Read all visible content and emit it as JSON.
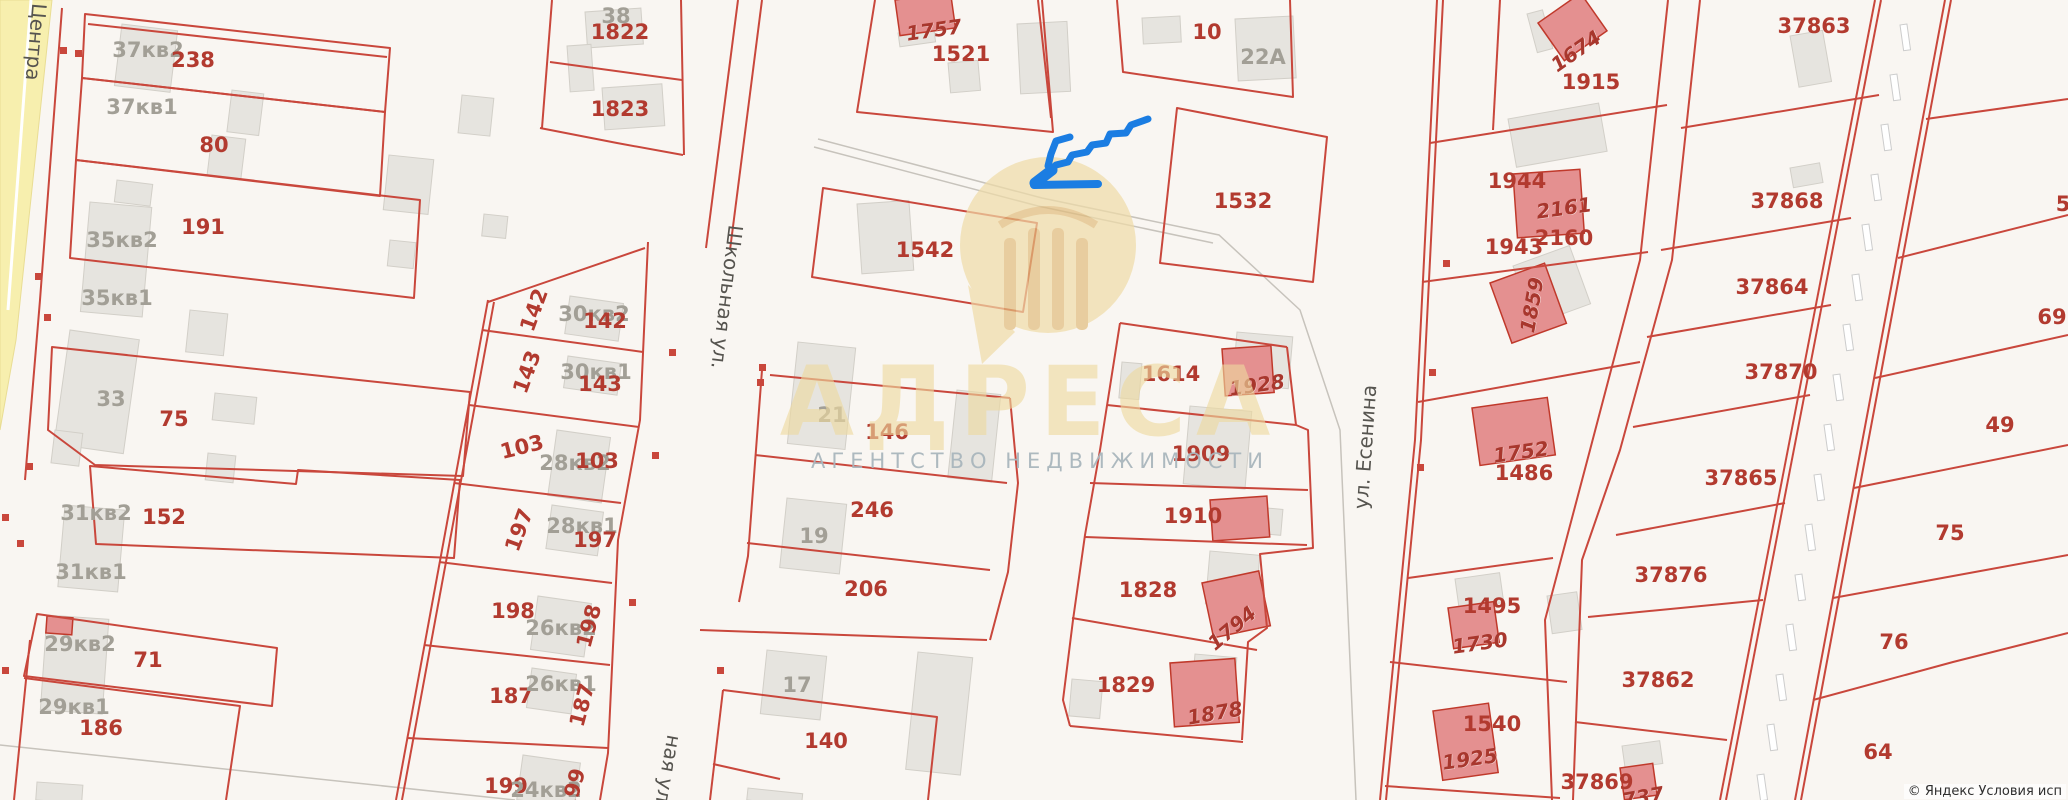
{
  "map": {
    "background": "#f9f6f2",
    "boundary_color": "#c9473c",
    "road_fill_yellow": "#f7efae",
    "building_grey": "#e6e4df",
    "building_red": "#e49090",
    "arrow_color": "#1b7de2",
    "watermark": {
      "title": "АДРЕСА",
      "subtitle": "АГЕНТСТВО НЕДВИЖИМОСТИ",
      "title_color": "#eeda9f",
      "subtitle_color": "#a9b6bd",
      "logo_color": "#ecd6a2"
    },
    "attribution": "© Яндекс  Условия исп",
    "labels": [
      {
        "t": "Центра",
        "x": 36,
        "y": 42,
        "r": 95,
        "k": "s"
      },
      {
        "t": "Школьная ул.",
        "x": 727,
        "y": 297,
        "r": 97,
        "k": "s"
      },
      {
        "t": "ная ул.",
        "x": 668,
        "y": 772,
        "r": 100,
        "k": "s"
      },
      {
        "t": "ул. Есенина",
        "x": 1365,
        "y": 447,
        "r": -86,
        "k": "s"
      },
      {
        "t": "37кв2",
        "x": 148,
        "y": 50,
        "k": "g"
      },
      {
        "t": "238",
        "x": 193,
        "y": 60,
        "k": "p"
      },
      {
        "t": "37кв1",
        "x": 142,
        "y": 107,
        "k": "g"
      },
      {
        "t": "80",
        "x": 214,
        "y": 145,
        "k": "p"
      },
      {
        "t": "35кв2",
        "x": 122,
        "y": 240,
        "k": "g"
      },
      {
        "t": "191",
        "x": 203,
        "y": 227,
        "k": "p"
      },
      {
        "t": "35кв1",
        "x": 117,
        "y": 298,
        "k": "g"
      },
      {
        "t": "33",
        "x": 111,
        "y": 399,
        "k": "g"
      },
      {
        "t": "75",
        "x": 174,
        "y": 419,
        "k": "p"
      },
      {
        "t": "31кв2",
        "x": 96,
        "y": 513,
        "k": "g"
      },
      {
        "t": "152",
        "x": 164,
        "y": 517,
        "k": "p"
      },
      {
        "t": "31кв1",
        "x": 91,
        "y": 572,
        "k": "g"
      },
      {
        "t": "29кв2",
        "x": 80,
        "y": 644,
        "k": "g"
      },
      {
        "t": "71",
        "x": 148,
        "y": 660,
        "k": "p"
      },
      {
        "t": "29кв1",
        "x": 74,
        "y": 707,
        "k": "g"
      },
      {
        "t": "186",
        "x": 101,
        "y": 728,
        "k": "p"
      },
      {
        "t": "38",
        "x": 616,
        "y": 16,
        "k": "g"
      },
      {
        "t": "1822",
        "x": 620,
        "y": 32,
        "k": "p"
      },
      {
        "t": "1823",
        "x": 620,
        "y": 109,
        "k": "p"
      },
      {
        "t": "142",
        "x": 534,
        "y": 310,
        "r": -70,
        "k": "p"
      },
      {
        "t": "30кв2",
        "x": 594,
        "y": 314,
        "k": "g"
      },
      {
        "t": "142",
        "x": 605,
        "y": 321,
        "k": "p"
      },
      {
        "t": "143",
        "x": 527,
        "y": 372,
        "r": -70,
        "k": "p"
      },
      {
        "t": "30кв1",
        "x": 596,
        "y": 372,
        "k": "g"
      },
      {
        "t": "143",
        "x": 600,
        "y": 384,
        "k": "p"
      },
      {
        "t": "103",
        "x": 522,
        "y": 447,
        "r": -14,
        "k": "p"
      },
      {
        "t": "28кв2",
        "x": 575,
        "y": 463,
        "k": "g"
      },
      {
        "t": "103",
        "x": 597,
        "y": 461,
        "k": "p"
      },
      {
        "t": "197",
        "x": 519,
        "y": 530,
        "r": -70,
        "k": "p"
      },
      {
        "t": "28кв1",
        "x": 582,
        "y": 526,
        "k": "g"
      },
      {
        "t": "197",
        "x": 595,
        "y": 540,
        "k": "p"
      },
      {
        "t": "198",
        "x": 513,
        "y": 611,
        "k": "p"
      },
      {
        "t": "26кв2",
        "x": 561,
        "y": 628,
        "k": "g"
      },
      {
        "t": "198",
        "x": 589,
        "y": 626,
        "r": -75,
        "k": "p"
      },
      {
        "t": "187",
        "x": 511,
        "y": 696,
        "k": "p"
      },
      {
        "t": "26кв1",
        "x": 561,
        "y": 684,
        "k": "g"
      },
      {
        "t": "187",
        "x": 582,
        "y": 705,
        "r": -75,
        "k": "p"
      },
      {
        "t": "199",
        "x": 506,
        "y": 786,
        "k": "p"
      },
      {
        "t": "24кв2",
        "x": 546,
        "y": 790,
        "k": "g"
      },
      {
        "t": "199",
        "x": 573,
        "y": 790,
        "r": -75,
        "k": "p"
      },
      {
        "t": "1757",
        "x": 934,
        "y": 30,
        "r": -8,
        "k": "bi"
      },
      {
        "t": "1521",
        "x": 961,
        "y": 54,
        "k": "p"
      },
      {
        "t": "10",
        "x": 1207,
        "y": 32,
        "k": "p"
      },
      {
        "t": "22A",
        "x": 1263,
        "y": 57,
        "k": "g"
      },
      {
        "t": "1532",
        "x": 1243,
        "y": 201,
        "k": "p"
      },
      {
        "t": "1542",
        "x": 925,
        "y": 250,
        "k": "p"
      },
      {
        "t": "21",
        "x": 832,
        "y": 415,
        "k": "g"
      },
      {
        "t": "146",
        "x": 887,
        "y": 432,
        "k": "p"
      },
      {
        "t": "246",
        "x": 872,
        "y": 510,
        "k": "p"
      },
      {
        "t": "19",
        "x": 814,
        "y": 536,
        "k": "g"
      },
      {
        "t": "206",
        "x": 866,
        "y": 589,
        "k": "p"
      },
      {
        "t": "17",
        "x": 797,
        "y": 685,
        "k": "g"
      },
      {
        "t": "140",
        "x": 826,
        "y": 741,
        "k": "p"
      },
      {
        "t": "1614",
        "x": 1171,
        "y": 374,
        "k": "p"
      },
      {
        "t": "1928",
        "x": 1257,
        "y": 385,
        "r": -8,
        "k": "bi"
      },
      {
        "t": "1909",
        "x": 1201,
        "y": 454,
        "k": "p"
      },
      {
        "t": "1910",
        "x": 1193,
        "y": 516,
        "k": "p"
      },
      {
        "t": "1828",
        "x": 1148,
        "y": 590,
        "k": "p"
      },
      {
        "t": "1794",
        "x": 1232,
        "y": 628,
        "r": -40,
        "k": "bi"
      },
      {
        "t": "1829",
        "x": 1126,
        "y": 685,
        "k": "p"
      },
      {
        "t": "1878",
        "x": 1215,
        "y": 713,
        "r": -10,
        "k": "bi"
      },
      {
        "t": "1674",
        "x": 1576,
        "y": 51,
        "r": -35,
        "k": "bi"
      },
      {
        "t": "1915",
        "x": 1591,
        "y": 82,
        "k": "p"
      },
      {
        "t": "1944",
        "x": 1517,
        "y": 181,
        "k": "p"
      },
      {
        "t": "2161",
        "x": 1564,
        "y": 208,
        "r": -8,
        "k": "bi"
      },
      {
        "t": "2160",
        "x": 1564,
        "y": 238,
        "k": "p"
      },
      {
        "t": "1943",
        "x": 1514,
        "y": 247,
        "k": "p"
      },
      {
        "t": "1859",
        "x": 1532,
        "y": 305,
        "r": -80,
        "k": "bi"
      },
      {
        "t": "1752",
        "x": 1521,
        "y": 452,
        "r": -8,
        "k": "bi"
      },
      {
        "t": "1486",
        "x": 1524,
        "y": 473,
        "k": "p"
      },
      {
        "t": "1495",
        "x": 1492,
        "y": 606,
        "k": "p"
      },
      {
        "t": "1730",
        "x": 1480,
        "y": 643,
        "r": -8,
        "k": "bi"
      },
      {
        "t": "1540",
        "x": 1492,
        "y": 724,
        "k": "p"
      },
      {
        "t": "1925",
        "x": 1470,
        "y": 759,
        "r": -8,
        "k": "bi"
      },
      {
        "t": "37869",
        "x": 1597,
        "y": 782,
        "k": "p"
      },
      {
        "t": "737",
        "x": 1643,
        "y": 797,
        "r": -10,
        "k": "bi"
      },
      {
        "t": "37863",
        "x": 1814,
        "y": 26,
        "k": "p"
      },
      {
        "t": "37868",
        "x": 1787,
        "y": 201,
        "k": "p"
      },
      {
        "t": "37864",
        "x": 1772,
        "y": 287,
        "k": "p"
      },
      {
        "t": "37870",
        "x": 1781,
        "y": 372,
        "k": "p"
      },
      {
        "t": "37865",
        "x": 1741,
        "y": 478,
        "k": "p"
      },
      {
        "t": "37876",
        "x": 1671,
        "y": 575,
        "k": "p"
      },
      {
        "t": "37862",
        "x": 1658,
        "y": 680,
        "k": "p"
      },
      {
        "t": "5",
        "x": 2063,
        "y": 204,
        "k": "p"
      },
      {
        "t": "69",
        "x": 2052,
        "y": 317,
        "k": "p"
      },
      {
        "t": "49",
        "x": 2000,
        "y": 425,
        "k": "p"
      },
      {
        "t": "75",
        "x": 1950,
        "y": 533,
        "k": "p"
      },
      {
        "t": "76",
        "x": 1894,
        "y": 642,
        "k": "p"
      },
      {
        "t": "64",
        "x": 1878,
        "y": 752,
        "k": "p"
      }
    ]
  }
}
